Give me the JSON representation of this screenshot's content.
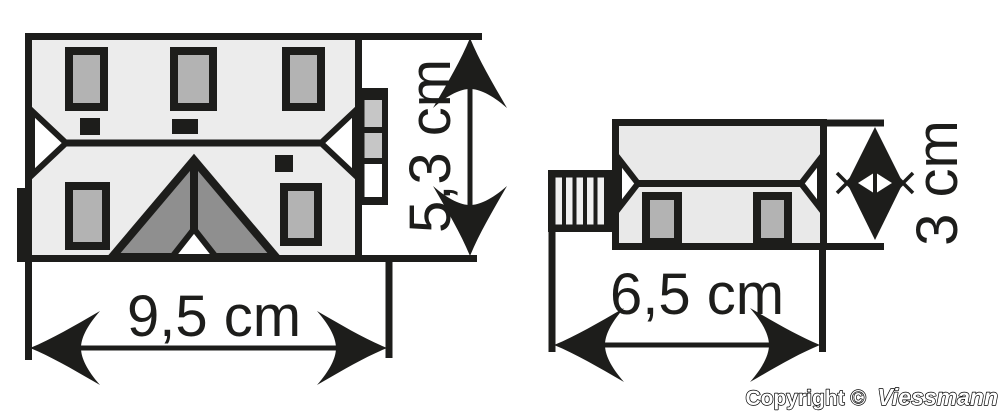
{
  "title": "Viessmann model building dimension diagram",
  "colors": {
    "line": "#1d1d1b",
    "roof_left": "#ececec",
    "roof_right": "#e9e9e9",
    "window_gray": "#b3b3b3",
    "dormer_gray": "#8f8f8f",
    "annex_gray": "#c6c6c6",
    "hip_white": "#ffffff",
    "stair_stripe": "#f0f0f0"
  },
  "buildings": {
    "left": {
      "name": "large building roof plan",
      "width_label": "9,5 cm",
      "height_label": "5,3 cm",
      "features": [
        "3 roof windows top",
        "2 roof windows bottom",
        "3 chimneys",
        "center gable dormer",
        "side annex with 2 skylights",
        "half-hipped roof ends"
      ]
    },
    "right": {
      "name": "small building roof plan",
      "width_label": "6,5 cm",
      "height_label": "3 cm",
      "features": [
        "2 roof windows",
        "hipped roof ends",
        "entrance stairs on left"
      ]
    }
  },
  "copyright": {
    "prefix": "Copyright ©",
    "brand": "Viessmann"
  }
}
